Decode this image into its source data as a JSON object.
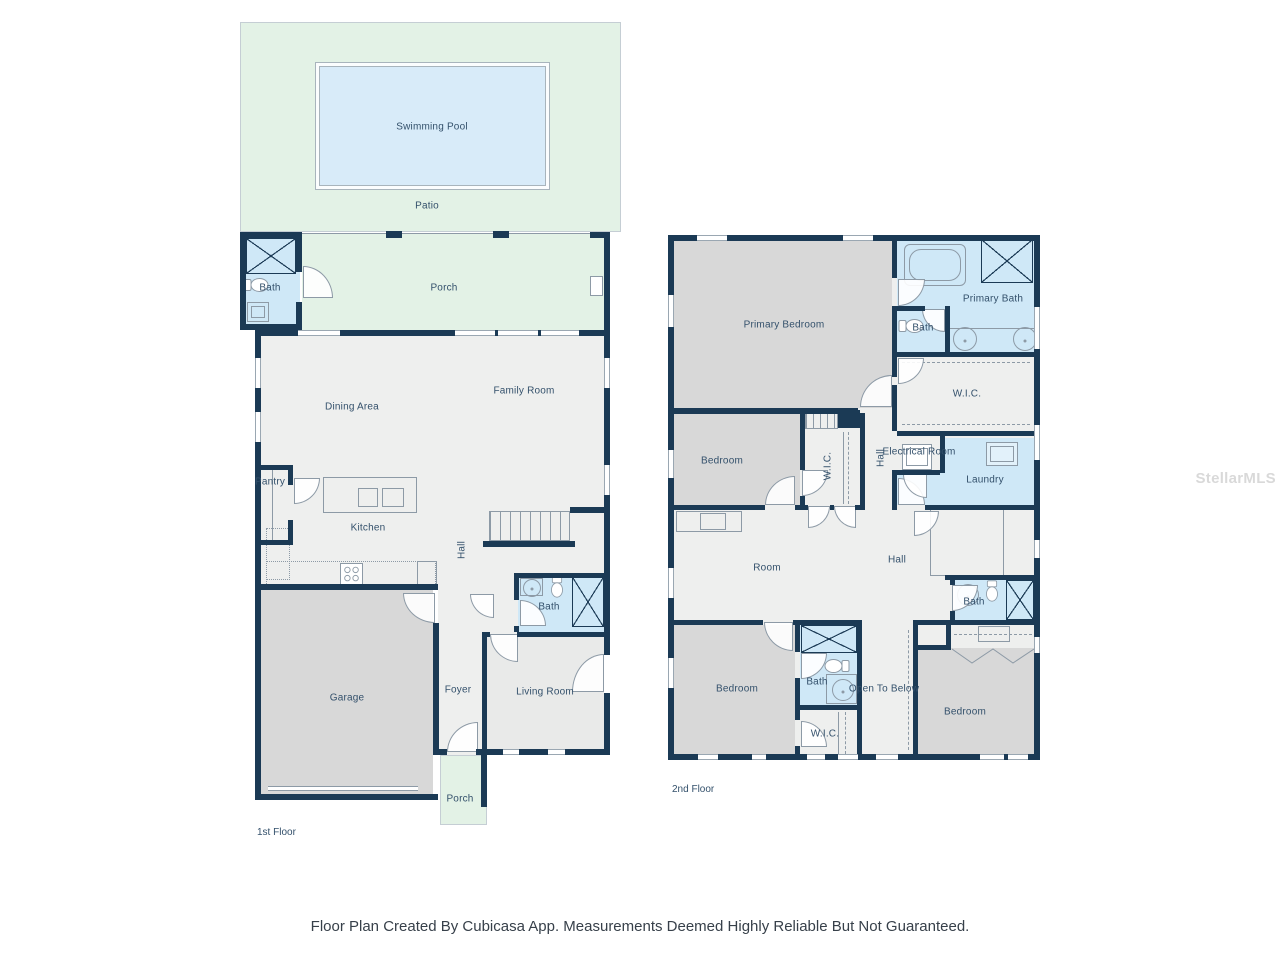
{
  "watermark": "StellarMLS",
  "footer_note": "Floor Plan Created By Cubicasa App. Measurements Deemed Highly Reliable But Not Guaranteed.",
  "f1": {
    "floor_name": "1st Floor",
    "swimming_pool": "Swimming Pool",
    "patio": "Patio",
    "porch_back": "Porch",
    "pool_bath": "Bath",
    "family_room": "Family Room",
    "dining_area": "Dining Area",
    "pantry": "Pantry",
    "kitchen": "Kitchen",
    "hall": "Hall",
    "bath": "Bath",
    "garage": "Garage",
    "foyer": "Foyer",
    "living_room": "Living Room",
    "porch_front": "Porch"
  },
  "f2": {
    "floor_name": "2nd Floor",
    "primary_bedroom": "Primary Bedroom",
    "primary_bath": "Primary Bath",
    "bath_small": "Bath",
    "wic_primary": "W.I.C.",
    "bedroom_left": "Bedroom",
    "wic_left": "W.I.C.",
    "hall_upper": "Hall",
    "electrical_room": "Electrical Room",
    "laundry": "Laundry",
    "room": "Room",
    "hall_lower": "Hall",
    "bath_right": "Bath",
    "bedroom_bottom_left": "Bedroom",
    "bath_middle": "Bath",
    "open_to_below": "Open To Below",
    "wic_bottom": "W.I.C.",
    "bedroom_bottom_right": "Bedroom"
  },
  "colors": {
    "wall": "#1b3a55",
    "bedroom_gray": "#d8d8d8",
    "floor_light": "#eeefee",
    "bath_blue": "#cfe8f7",
    "pool_blue": "#d8ebf9",
    "outdoor_green": "#e3f2e6",
    "label": "#33506b",
    "fixture_line": "#8d9aa6",
    "window_line": "#9aa7b2"
  }
}
